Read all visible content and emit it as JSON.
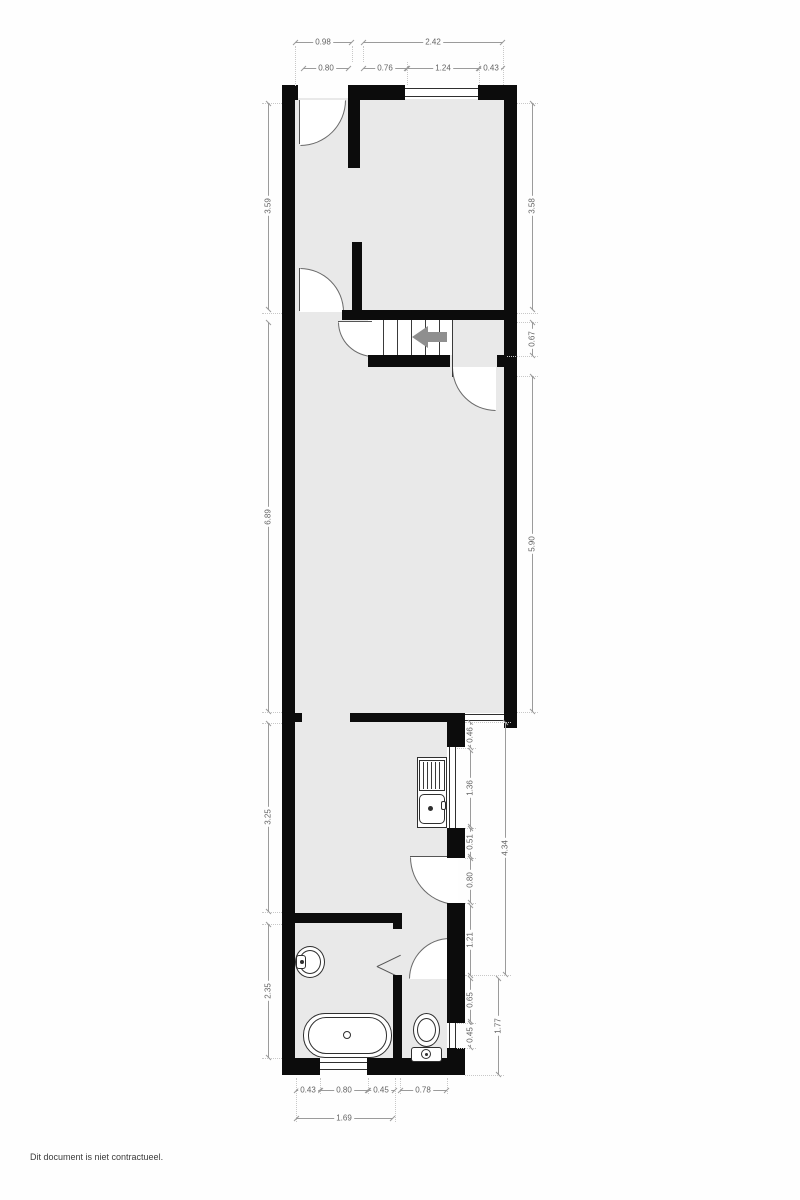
{
  "dims": {
    "top_left_total": "0.98",
    "top_right_total": "2.42",
    "top_door": "0.80",
    "top_wall_mid": "0.76",
    "top_window": "1.24",
    "top_wall_right": "0.43",
    "left_room_top": "3.59",
    "left_room_main": "6.89",
    "left_kitchen": "3.25",
    "left_bathroom": "2.35",
    "right_room_top": "3.58",
    "right_landing": "0.67",
    "right_room_main": "5.90",
    "right_stub": "0.46",
    "right_kitchen_window": "1.36",
    "right_pier": "0.51",
    "right_kitchen_door": "0.80",
    "right_hall": "1.21",
    "right_wc_wall": "0.65",
    "right_wc_window": "0.45",
    "right_lower_total": "4.34",
    "right_wc_total": "1.77",
    "bottom_wall_left": "0.43",
    "bottom_window": "0.80",
    "bottom_wall_right": "0.45",
    "bottom_wc": "0.78",
    "bottom_bath_total": "1.69"
  },
  "footer": {
    "disclaimer": "Dit document is niet contractueel."
  }
}
